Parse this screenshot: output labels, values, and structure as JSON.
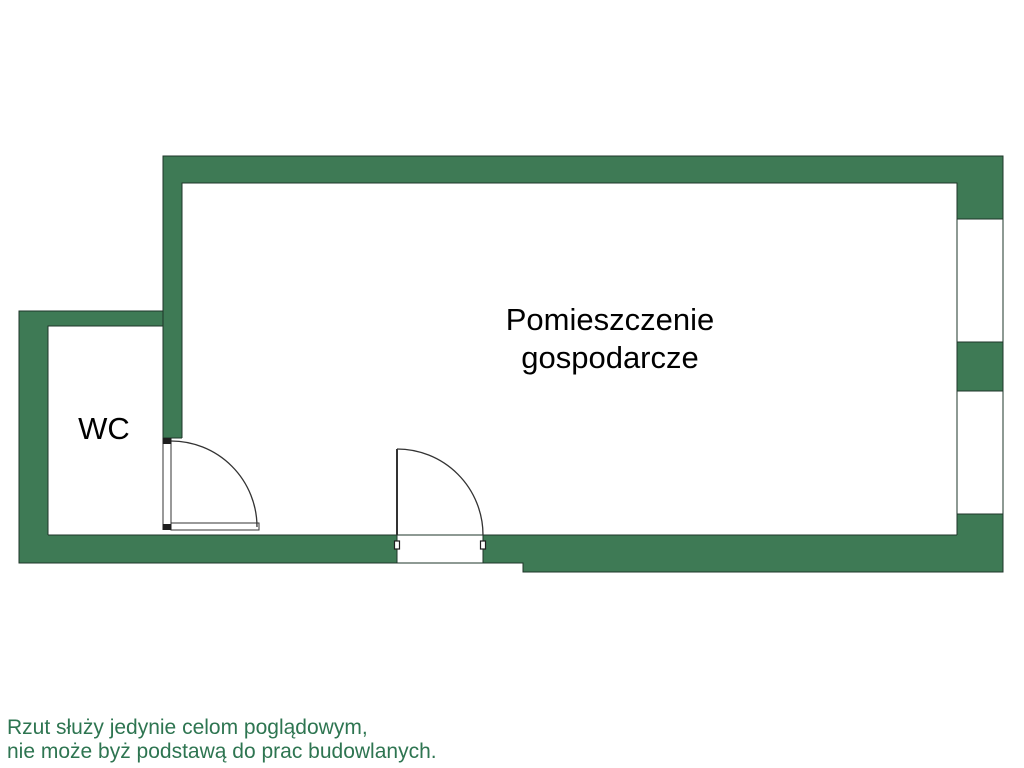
{
  "floorplan": {
    "main_room": {
      "label_line1": "Pomieszczenie",
      "label_line2": "gospodarcze"
    },
    "wc_room": {
      "label": "WC"
    },
    "disclaimer": {
      "line1": "Rzut służy jedynie celom poglądowym,",
      "line2": "nie może byż podstawą do prac budowlanych."
    },
    "colors": {
      "wall_fill": "#3E7A55",
      "wall_outline": "#1E3529",
      "door_line": "#333333",
      "room_label_text": "#000000",
      "disclaimer_text": "#2E7551",
      "background": "#FFFFFF"
    }
  }
}
